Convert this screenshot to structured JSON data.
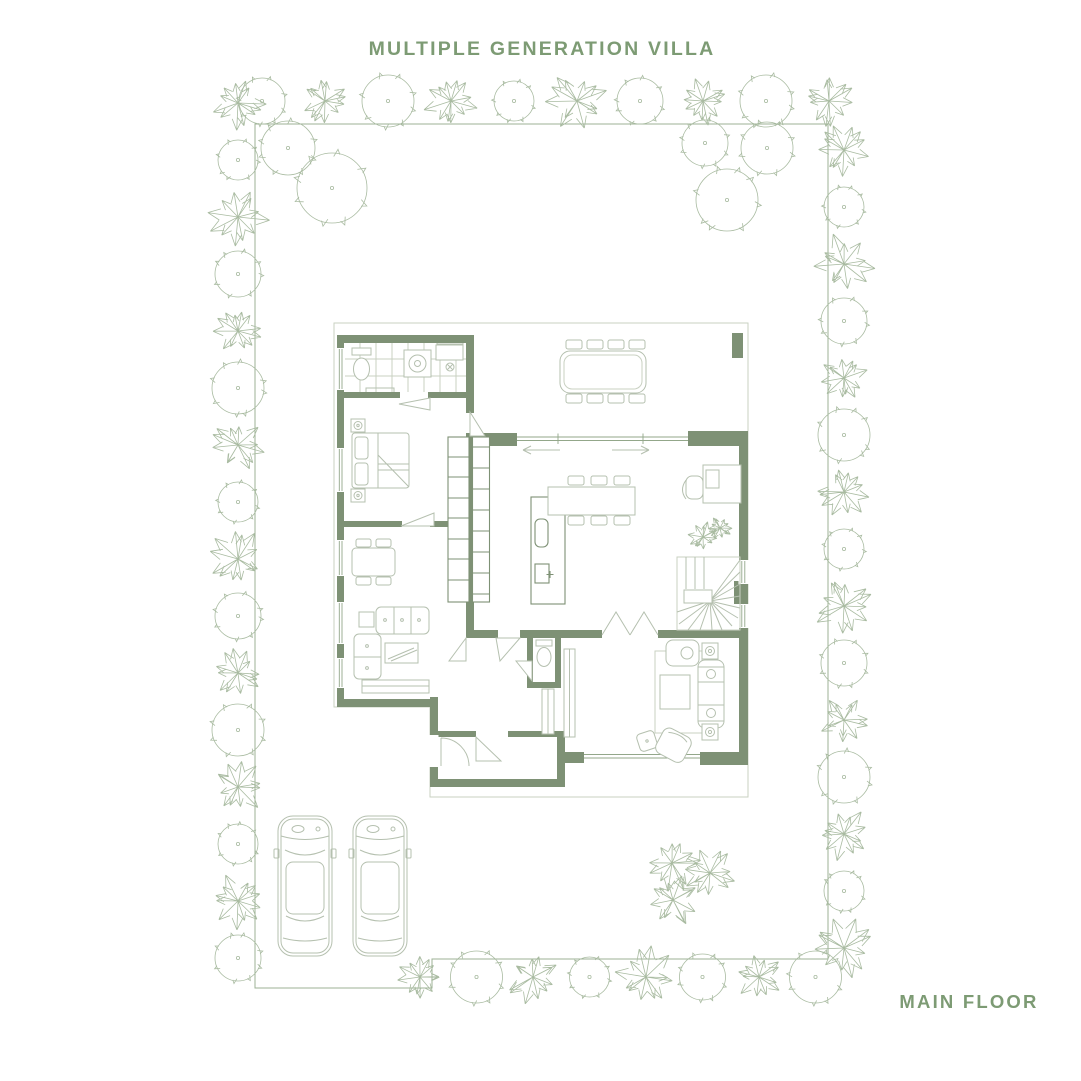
{
  "title": "MULTIPLE GENERATION VILLA",
  "floor_label": "MAIN FLOOR",
  "colors": {
    "accent_text": "#7d9b74",
    "wall": "#7e9175",
    "furniture_line": "#b5c0af",
    "soft_outline": "#c9d1c2",
    "glass_line": "#93a78a",
    "tree_line": "#a9bba1",
    "boundary_line": "#9cb294",
    "background": "#ffffff"
  }
}
